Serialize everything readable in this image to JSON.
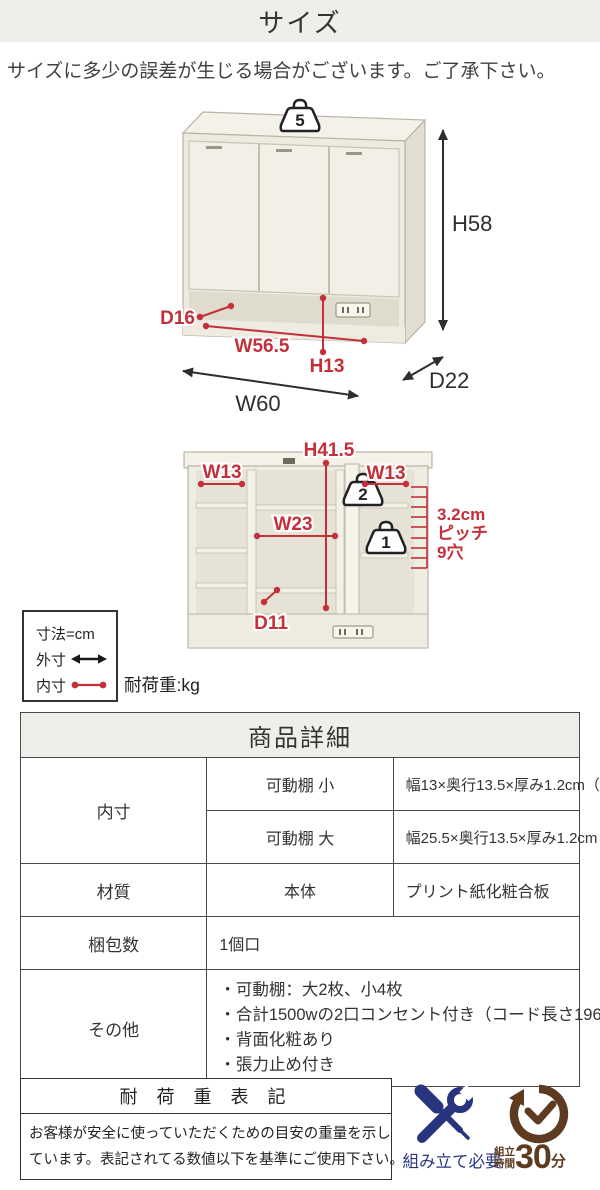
{
  "colors": {
    "accent_red": "#c4303a",
    "header_bg": "#f0eeea",
    "assembly_blue": "#28357e",
    "time_brown": "#5d3a20",
    "text": "#333333"
  },
  "page": {
    "title": "サイズ",
    "notice": "サイズに多少の誤差が生じる場合がございます。ご了承下さい。"
  },
  "diagram_top": {
    "load_weight": "5",
    "height": "H58",
    "depth": "D22",
    "width": "W60",
    "inner_depth": "D16",
    "inner_width": "W56.5",
    "inner_height": "H13"
  },
  "diagram_inner": {
    "inner_height": "H41.5",
    "left_width": "W13",
    "right_width": "W13",
    "center_width": "W23",
    "bottom_depth": "D11",
    "center_load": "2",
    "right_load": "1",
    "pitch_lines": [
      "3.2cm",
      "ピッチ",
      "9穴"
    ]
  },
  "legend": {
    "unit": "寸法=cm",
    "outer": "外寸",
    "inner": "内寸",
    "load_unit": "耐荷重:kg"
  },
  "table": {
    "title": "商品詳細",
    "row_inner_label": "内寸",
    "row_inner_small_label": "可動棚 小",
    "row_inner_small_value": "幅13×奥行13.5×厚み1.2cm（3.2cmピッチ9穴）",
    "row_inner_large_label": "可動棚 大",
    "row_inner_large_value": "幅25.5×奥行13.5×厚み1.2cm（3.2cmピッチ9穴）",
    "row_material_label": "材質",
    "row_material_sub": "本体",
    "row_material_value": "プリント紙化粧合板",
    "row_package_label": "梱包数",
    "row_package_value": "1個口",
    "row_other_label": "その他",
    "other_items": [
      "・可動棚：大2枚、小4枚",
      "・合計1500wの2口コンセント付き（コード長さ196cm）",
      "・背面化粧あり",
      "・張力止め付き"
    ]
  },
  "load_note": {
    "title": "耐 荷 重 表 記",
    "line1": "お客様が安全に使っていただくための目安の重量を示し",
    "line2": "ています。表記されてる数値以下を基準にご使用下さい。"
  },
  "footer": {
    "assembly_label": "組み立て必要",
    "time_label_top": "組立",
    "time_label_bottom": "時間",
    "time_value": "30",
    "time_unit": "分"
  }
}
